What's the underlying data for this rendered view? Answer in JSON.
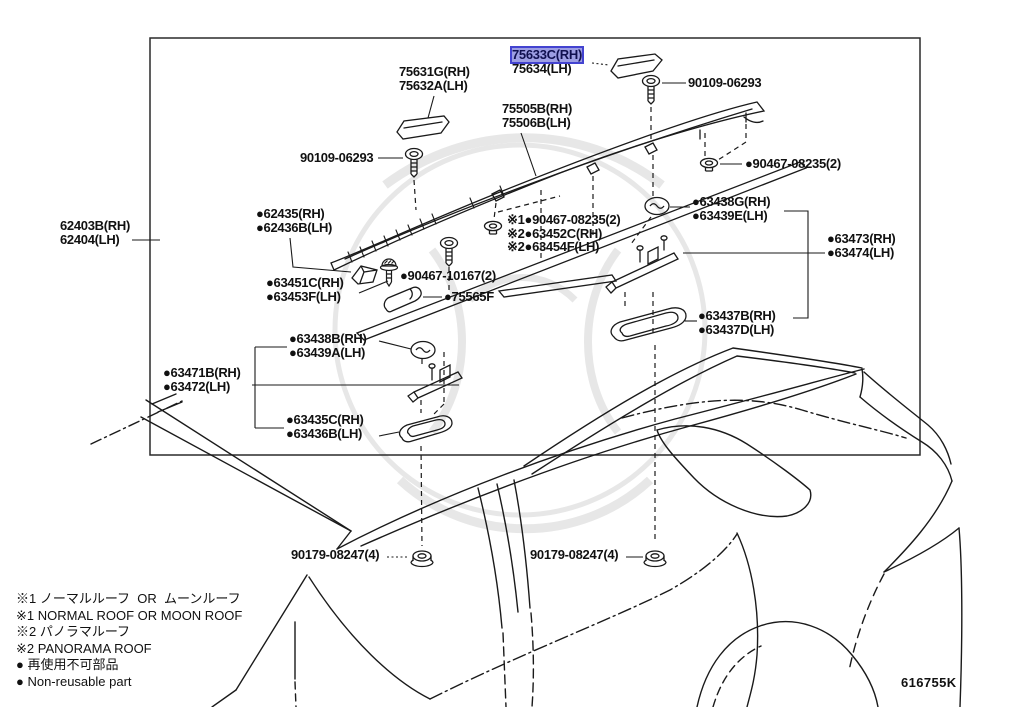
{
  "diagram": {
    "code": "616755K",
    "highlight_bg": "#9d9ee3",
    "highlight_border": "#4343d0",
    "labels": [
      {
        "id": "62403b",
        "x": 60,
        "y": 219,
        "lines": [
          "62403B(RH)",
          "62404(LH)"
        ]
      },
      {
        "id": "75631g",
        "x": 399,
        "y": 65,
        "lines": [
          "75631G(RH)",
          "75632A(LH)"
        ]
      },
      {
        "id": "75633c",
        "x": 512,
        "y": 48,
        "lines": [
          "75633C(RH)",
          "75634(LH)"
        ],
        "highlight": 0
      },
      {
        "id": "90109-06293-top",
        "x": 688,
        "y": 76,
        "lines": [
          "90109-06293"
        ]
      },
      {
        "id": "75505b",
        "x": 502,
        "y": 102,
        "lines": [
          "75505B(RH)",
          "75506B(LH)"
        ]
      },
      {
        "id": "90109-06293-left",
        "x": 300,
        "y": 151,
        "lines": [
          "90109-06293"
        ]
      },
      {
        "id": "90467-08235-right",
        "x": 745,
        "y": 157,
        "lines": [
          "●90467-08235(2)"
        ]
      },
      {
        "id": "62435",
        "x": 256,
        "y": 207,
        "lines": [
          "●62435(RH)",
          "●62436B(LH)"
        ]
      },
      {
        "id": "roof-variant-group",
        "x": 507,
        "y": 213,
        "lines": [
          "※1●90467-08235(2)",
          "※2●63452C(RH)",
          "※2●63454F(LH)"
        ]
      },
      {
        "id": "63438g",
        "x": 692,
        "y": 195,
        "lines": [
          "●63438G(RH)",
          "●63439E(LH)"
        ]
      },
      {
        "id": "63473",
        "x": 827,
        "y": 232,
        "lines": [
          "●63473(RH)",
          "●63474(LH)"
        ]
      },
      {
        "id": "90467-10167",
        "x": 400,
        "y": 269,
        "lines": [
          "●90467-10167(2)"
        ]
      },
      {
        "id": "63451c",
        "x": 266,
        "y": 276,
        "lines": [
          "●63451C(RH)",
          "●63453F(LH)"
        ]
      },
      {
        "id": "75565f",
        "x": 444,
        "y": 290,
        "lines": [
          "●75565F"
        ]
      },
      {
        "id": "63437b",
        "x": 698,
        "y": 309,
        "lines": [
          "●63437B(RH)",
          "●63437D(LH)"
        ]
      },
      {
        "id": "63438b",
        "x": 289,
        "y": 332,
        "lines": [
          "●63438B(RH)",
          "●63439A(LH)"
        ]
      },
      {
        "id": "63471b",
        "x": 163,
        "y": 366,
        "lines": [
          "●63471B(RH)",
          "●63472(LH)"
        ]
      },
      {
        "id": "63435c",
        "x": 286,
        "y": 413,
        "lines": [
          "●63435C(RH)",
          "●63436B(LH)"
        ]
      },
      {
        "id": "90179-08247-left",
        "x": 291,
        "y": 548,
        "lines": [
          "90179-08247(4)"
        ]
      },
      {
        "id": "90179-08247-right",
        "x": 530,
        "y": 548,
        "lines": [
          "90179-08247(4)"
        ]
      }
    ],
    "notes": [
      "※1 ノーマルルーフ  OR  ムーンルーフ",
      "※1 NORMAL ROOF OR MOON ROOF",
      "※2 パノラマルーフ",
      "※2 PANORAMA ROOF",
      "● 再使用不可部品",
      "● Non-reusable part"
    ]
  }
}
